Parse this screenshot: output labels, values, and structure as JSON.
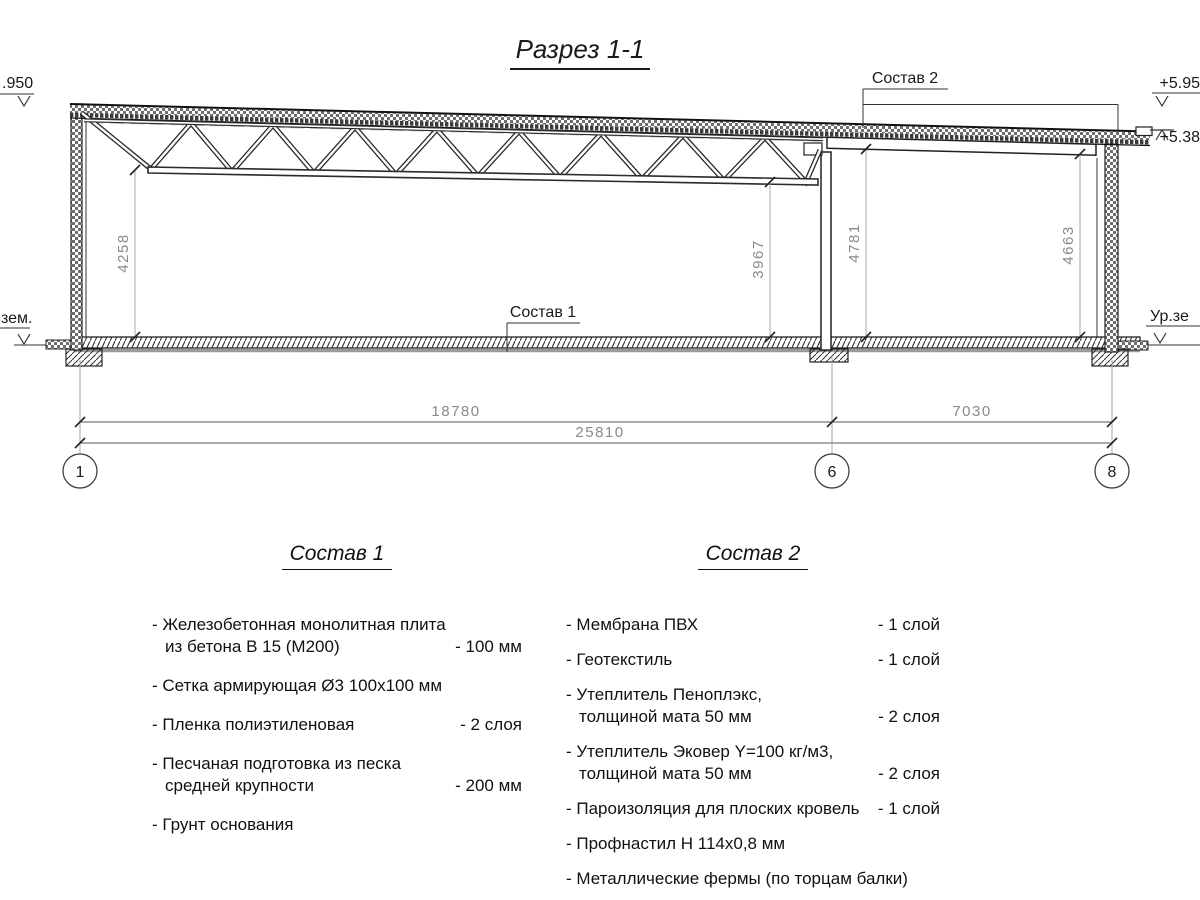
{
  "title": "Разрез 1-1",
  "callouts": {
    "sostav1": "Состав 1",
    "sostav2": "Состав 2"
  },
  "elevations": {
    "left_top": ".950",
    "right_top": "+5.95",
    "right_low": "+5.38",
    "ground_left": "зем.",
    "ground_right": "Ур.зе"
  },
  "dimensions": {
    "v_left": "4258",
    "v_mid_left": "3967",
    "v_mid_right": "4781",
    "v_right": "4663",
    "span_1_6": "18780",
    "span_6_8": "7030",
    "span_total": "25810"
  },
  "axes": {
    "a1": "1",
    "a2": "6",
    "a3": "8"
  },
  "sostav1": {
    "heading": "Состав 1",
    "items": [
      {
        "line1": "- Железобетонная  монолитная плита",
        "line2": "из бетона В 15 (М200)",
        "value": "- 100 мм"
      },
      {
        "line1": "- Сетка армирующая Ø3 100х100 мм",
        "line2": "",
        "value": ""
      },
      {
        "line1": "- Пленка полиэтиленовая",
        "line2": "",
        "value": "-  2 слоя"
      },
      {
        "line1": "- Песчаная подготовка из песка",
        "line2": "средней крупности",
        "value": "- 200 мм"
      },
      {
        "line1": "- Грунт основания",
        "line2": "",
        "value": ""
      }
    ]
  },
  "sostav2": {
    "heading": "Состав 2",
    "items": [
      {
        "line1": "- Мембрана ПВХ",
        "line2": "",
        "value": "- 1 слой"
      },
      {
        "line1": "- Геотекстиль",
        "line2": "",
        "value": "- 1 слой"
      },
      {
        "line1": "- Утеплитель Пеноплэкс,",
        "line2": "толщиной мата 50 мм",
        "value": "- 2 слоя"
      },
      {
        "line1": "- Утеплитель Эковер Y=100 кг/м3,",
        "line2": "толщиной мата 50 мм",
        "value": "- 2 слоя"
      },
      {
        "line1": "- Пароизоляция для плоских кровель",
        "line2": "",
        "value": "- 1 слой"
      },
      {
        "line1": "- Профнастил Н 114х0,8 мм",
        "line2": "",
        "value": ""
      },
      {
        "line1": "- Металлические фермы (по торцам балки)",
        "line2": "",
        "value": ""
      }
    ]
  },
  "colors": {
    "line": "#1a1a1a",
    "dim_text": "#8a8a8a",
    "background": "#ffffff"
  }
}
